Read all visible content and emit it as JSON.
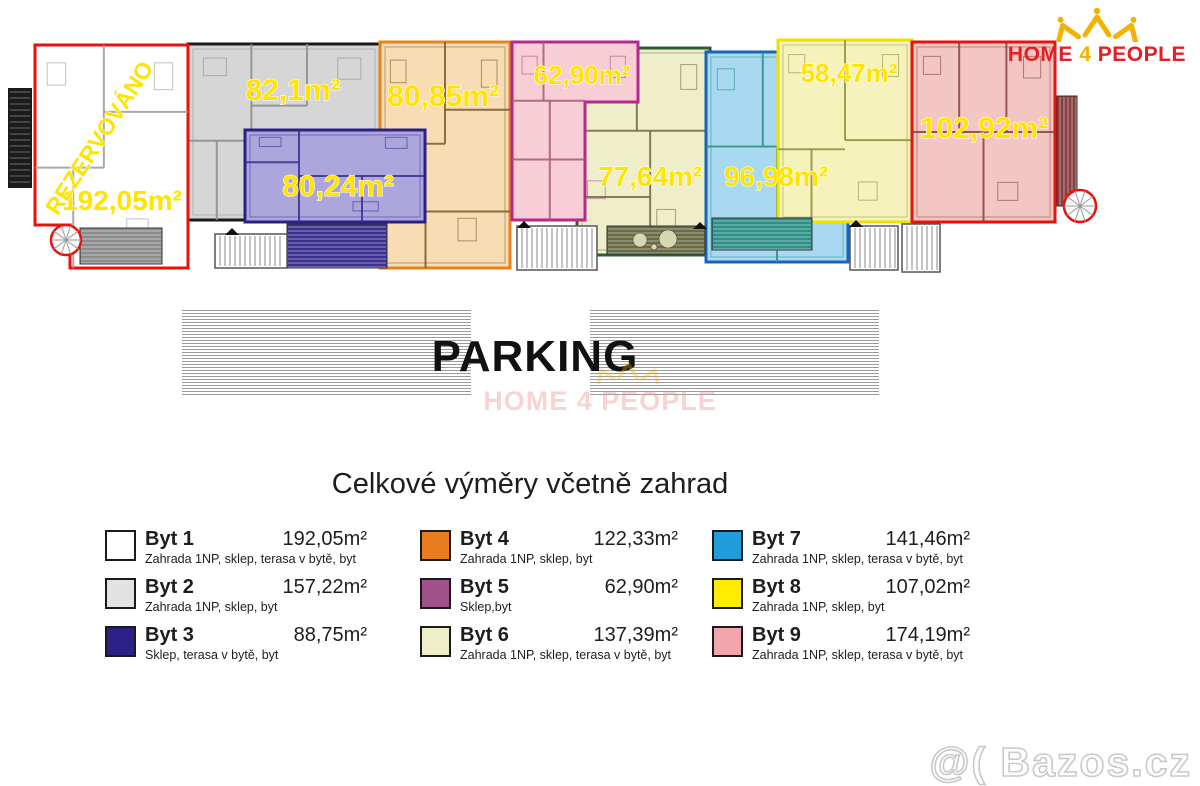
{
  "logo": {
    "home": "HOME",
    "four": "4",
    "people": "PEOPLE",
    "red": "#e31e24",
    "gold": "#f3b200"
  },
  "plan": {
    "label_color": "#ffe400",
    "units": [
      {
        "unit": "Byt 2",
        "fill": "#d6d6d6",
        "border": "#1a1a1a",
        "wall": "#8c8c8c",
        "rect": [
          188,
          44,
          192,
          176
        ],
        "partitions": [
          [
            0.33,
            0,
            0.33,
            0.55
          ],
          [
            0,
            0.55,
            0.33,
            0.55
          ],
          [
            0.33,
            0.35,
            0.62,
            0.35
          ],
          [
            0.62,
            0,
            0.62,
            0.35
          ],
          [
            0.15,
            0.55,
            0.15,
            1
          ]
        ]
      },
      {
        "unit": "Byt 4",
        "fill": "#f7dcb4",
        "border": "#e8821c",
        "wall": "#7a5a28",
        "rect": [
          380,
          42,
          130,
          226
        ],
        "partitions": [
          [
            0.5,
            0,
            0.5,
            0.45
          ],
          [
            0,
            0.45,
            0.5,
            0.45
          ],
          [
            0.5,
            0.3,
            1,
            0.3
          ],
          [
            0.35,
            0.45,
            0.35,
            1
          ],
          [
            0.35,
            0.75,
            1,
            0.75
          ]
        ]
      },
      {
        "unit": "Byt 3",
        "fill": "#aca6dc",
        "border": "#2b2086",
        "wall": "#3a2f8f",
        "rect": [
          245,
          130,
          180,
          92
        ],
        "partitions": [
          [
            0.3,
            0,
            0.3,
            1
          ],
          [
            0.3,
            0.5,
            1,
            0.5
          ],
          [
            0.65,
            0.5,
            0.65,
            1
          ],
          [
            0,
            0.35,
            0.3,
            0.35
          ]
        ]
      },
      {
        "unit": "Byt 6",
        "fill": "#eeeeca",
        "border": "#2e5c34",
        "wall": "#6b6b46",
        "rect": [
          577,
          48,
          133,
          207
        ],
        "partitions": [
          [
            0.45,
            0,
            0.45,
            0.4
          ],
          [
            0,
            0.4,
            1,
            0.4
          ],
          [
            0.55,
            0.4,
            0.55,
            1
          ],
          [
            0,
            0.72,
            0.55,
            0.72
          ]
        ]
      },
      {
        "unit": "Byt 5",
        "fill": "#f7ced6",
        "border": "#b5288c",
        "wall": "#a85a78",
        "polygon": [
          [
            512,
            42
          ],
          [
            638,
            42
          ],
          [
            638,
            102
          ],
          [
            585,
            102
          ],
          [
            585,
            220
          ],
          [
            512,
            220
          ]
        ],
        "partitions": [
          [
            0.25,
            0,
            0.25,
            0.33
          ],
          [
            0,
            0.33,
            0.58,
            0.33
          ],
          [
            0.3,
            0.33,
            0.3,
            1
          ],
          [
            0,
            0.66,
            0.58,
            0.66
          ]
        ]
      },
      {
        "unit": "Byt 7",
        "fill": "#a8d9f0",
        "border": "#1467b8",
        "wall": "#2e8f86",
        "rect": [
          706,
          52,
          142,
          210
        ],
        "partitions": [
          [
            0.4,
            0,
            0.4,
            0.45
          ],
          [
            0,
            0.45,
            1,
            0.45
          ],
          [
            0.5,
            0.45,
            0.5,
            1
          ],
          [
            0.75,
            0,
            0.75,
            0.45
          ]
        ]
      },
      {
        "unit": "Byt 8",
        "fill": "#f6f2bc",
        "border": "#f0e000",
        "wall": "#8f8f3a",
        "rect": [
          778,
          40,
          134,
          182
        ],
        "partitions": [
          [
            0.5,
            0,
            0.5,
            0.55
          ],
          [
            0.5,
            0.55,
            1,
            0.55
          ],
          [
            0,
            0.6,
            0.5,
            0.6
          ],
          [
            0.25,
            0.6,
            0.25,
            1
          ]
        ]
      },
      {
        "unit": "Byt 9",
        "fill": "#f2c6c2",
        "border": "#e8120c",
        "wall": "#8a4040",
        "rect": [
          912,
          42,
          143,
          180
        ],
        "partitions": [
          [
            0.33,
            0,
            0.33,
            0.5
          ],
          [
            0.66,
            0,
            0.66,
            0.5
          ],
          [
            0,
            0.5,
            1,
            0.5
          ],
          [
            0.5,
            0.5,
            0.5,
            1
          ]
        ]
      },
      {
        "unit": "Byt 1",
        "fill": "#ffffff",
        "border": "#e8120c",
        "wall": "#9a9a9a",
        "polygon": [
          [
            35,
            45
          ],
          [
            188,
            45
          ],
          [
            188,
            268
          ],
          [
            70,
            268
          ],
          [
            70,
            225
          ],
          [
            35,
            225
          ]
        ],
        "partitions": [
          [
            0.45,
            0,
            0.45,
            0.55
          ],
          [
            0,
            0.55,
            0.45,
            0.55
          ],
          [
            0.45,
            0.3,
            1,
            0.3
          ],
          [
            0.25,
            0.55,
            0.25,
            1
          ]
        ]
      }
    ],
    "labels": [
      {
        "unit": "Byt 1",
        "text": "192,05m²",
        "x": 122,
        "y": 210,
        "size": 28
      },
      {
        "unit": "Byt 2",
        "text": "82,1m²",
        "x": 293,
        "y": 100,
        "size": 30
      },
      {
        "unit": "Byt 3",
        "text": "80,24m²",
        "x": 338,
        "y": 196,
        "size": 30
      },
      {
        "unit": "Byt 4",
        "text": "80,85m²",
        "x": 443,
        "y": 106,
        "size": 30
      },
      {
        "unit": "Byt 5",
        "text": "62,90m²",
        "x": 582,
        "y": 84,
        "size": 26
      },
      {
        "unit": "Byt 6",
        "text": "77,64m²",
        "x": 650,
        "y": 186,
        "size": 28
      },
      {
        "unit": "Byt 7",
        "text": "96,98m²",
        "x": 776,
        "y": 186,
        "size": 28
      },
      {
        "unit": "Byt 8",
        "text": "58,47m²",
        "x": 849,
        "y": 82,
        "size": 26
      },
      {
        "unit": "Byt 9",
        "text": "102,92m²",
        "x": 984,
        "y": 138,
        "size": 30
      }
    ],
    "reserved": {
      "text": "REZERVOVÁNO",
      "x": 106,
      "y": 142,
      "rotation": -57,
      "size": 23
    },
    "decks": [
      {
        "x": 80,
        "y": 228,
        "w": 82,
        "h": 36,
        "base": "#8c8c8c",
        "dir": "h"
      },
      {
        "x": 287,
        "y": 224,
        "w": 100,
        "h": 44,
        "base": "#3b3190",
        "dir": "h"
      },
      {
        "x": 607,
        "y": 226,
        "w": 98,
        "h": 28,
        "base": "#6b6b46",
        "dir": "h",
        "circles": [
          [
            640,
            240,
            7
          ],
          [
            668,
            239,
            9
          ],
          [
            654,
            247,
            3
          ]
        ]
      },
      {
        "x": 712,
        "y": 218,
        "w": 100,
        "h": 32,
        "base": "#2e8f86",
        "dir": "h"
      },
      {
        "x": 1057,
        "y": 96,
        "w": 20,
        "h": 110,
        "base": "#8a4040",
        "dir": "v"
      }
    ],
    "stairs": [
      [
        215,
        234,
        72,
        34
      ],
      [
        517,
        226,
        80,
        44
      ],
      [
        850,
        226,
        48,
        44
      ],
      [
        902,
        224,
        38,
        48
      ]
    ],
    "spirals": [
      [
        66,
        240,
        15
      ],
      [
        1080,
        206,
        16
      ]
    ],
    "black_bar": [
      8,
      88,
      24,
      100
    ],
    "triangles": [
      [
        232,
        228
      ],
      [
        524,
        221
      ],
      [
        700,
        222
      ],
      [
        856,
        220
      ]
    ]
  },
  "parking": {
    "label": "PARKING",
    "watermark_line": "HOME 4 PEOPLE"
  },
  "legend_title": "Celkové výměry včetně zahrad",
  "legend": [
    {
      "name": "Byt 1",
      "area": "192,05m²",
      "desc": "Zahrada 1NP, sklep, terasa v bytě, byt",
      "color": "#ffffff"
    },
    {
      "name": "Byt 2",
      "area": "157,22m²",
      "desc": "Zahrada 1NP, sklep, byt",
      "color": "#e2e2e2"
    },
    {
      "name": "Byt 3",
      "area": "88,75m²",
      "desc": "Sklep, terasa v bytě, byt",
      "color": "#2b2086"
    },
    {
      "name": "Byt 4",
      "area": "122,33m²",
      "desc": "Zahrada 1NP, sklep, byt",
      "color": "#e87c1e"
    },
    {
      "name": "Byt 5",
      "area": "62,90m²",
      "desc": "Sklep,byt",
      "color": "#a0518a"
    },
    {
      "name": "Byt 6",
      "area": "137,39m²",
      "desc": "Zahrada 1NP, sklep, terasa v bytě, byt",
      "color": "#eeeeca"
    },
    {
      "name": "Byt 7",
      "area": "141,46m²",
      "desc": "Zahrada 1NP, sklep, terasa v bytě, byt",
      "color": "#1f9ddb"
    },
    {
      "name": "Byt 8",
      "area": "107,02m²",
      "desc": "Zahrada 1NP, sklep, byt",
      "color": "#ffec00"
    },
    {
      "name": "Byt 9",
      "area": "174,19m²",
      "desc": "Zahrada 1NP, sklep, terasa v bytě, byt",
      "color": "#f2a5ad"
    }
  ],
  "watermark": {
    "text": "@( Bazos.cz"
  }
}
